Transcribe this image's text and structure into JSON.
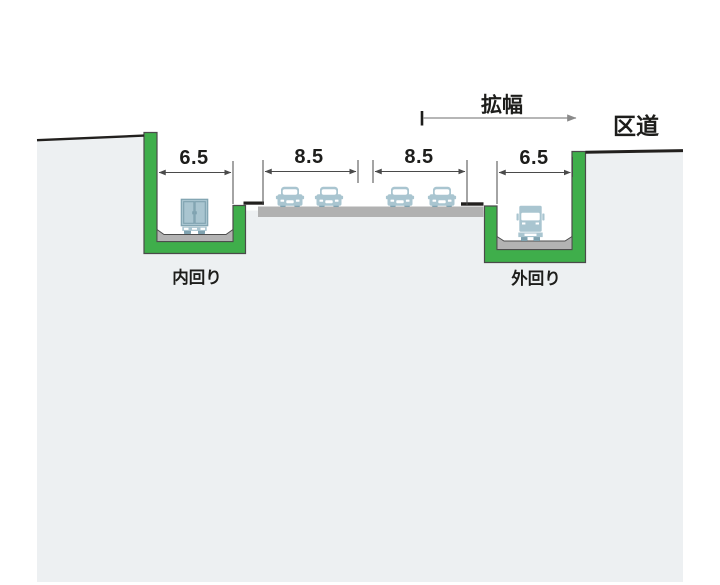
{
  "labels": {
    "widening": "拡幅",
    "ward_road": "区道",
    "inner_loop": "内回り",
    "outer_loop": "外回り"
  },
  "dimensions": {
    "inner_trench": "6.5",
    "left_roadway": "8.5",
    "right_roadway": "8.5",
    "outer_trench": "6.5"
  },
  "colors": {
    "wall_green": "#3fae4b",
    "ground_fill": "#edf0f2",
    "pavement_gray": "#b1b1b1",
    "line_black": "#22201e",
    "vehicle_blue": "#a9c5d0",
    "vehicle_dark": "#7fa2b0",
    "dim_line": "#4a4a4a"
  },
  "icons": {
    "truck_rear": "truck-rear-view-icon",
    "truck_front": "truck-front-view-icon",
    "car_front": "car-front-view-icon"
  }
}
